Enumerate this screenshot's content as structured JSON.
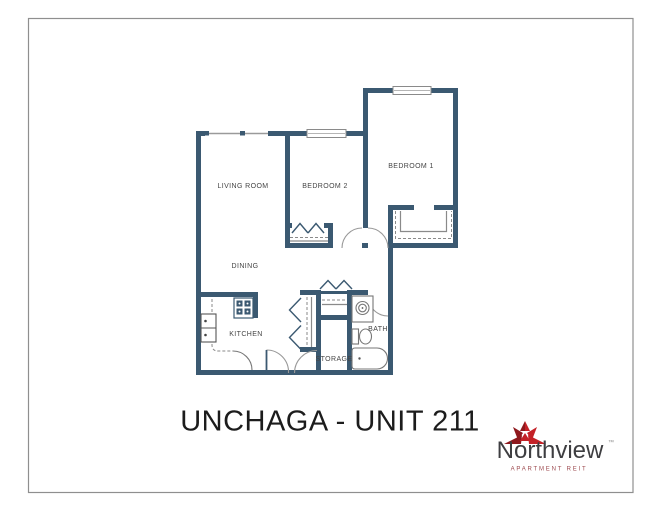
{
  "page": {
    "background": "#ffffff",
    "border_color": "#8f8f8f"
  },
  "title": "UNCHAGA - UNIT 211",
  "floorplan": {
    "wall_color": "#3b5971",
    "fixture_line_color": "#777777",
    "detail_line_color": "#8a8a8a",
    "label_color": "#454545",
    "rooms": [
      {
        "name": "living-room",
        "label": "LIVING ROOM"
      },
      {
        "name": "bedroom-2",
        "label": "BEDROOM 2"
      },
      {
        "name": "bedroom-1",
        "label": "BEDROOM 1"
      },
      {
        "name": "dining",
        "label": "DINING"
      },
      {
        "name": "kitchen",
        "label": "KITCHEN"
      },
      {
        "name": "storage",
        "label": "STORAGE"
      },
      {
        "name": "bath",
        "label": "BATH"
      }
    ]
  },
  "logo": {
    "brand": "Northview",
    "trademark": "™",
    "tagline": "APARTMENT REIT",
    "brand_color": "#3e3e41",
    "trademark_color": "#8a8a8a",
    "tagline_color": "#9d4a4f",
    "leaf_red": "#c42127",
    "leaf_dark_red": "#8e181d"
  }
}
